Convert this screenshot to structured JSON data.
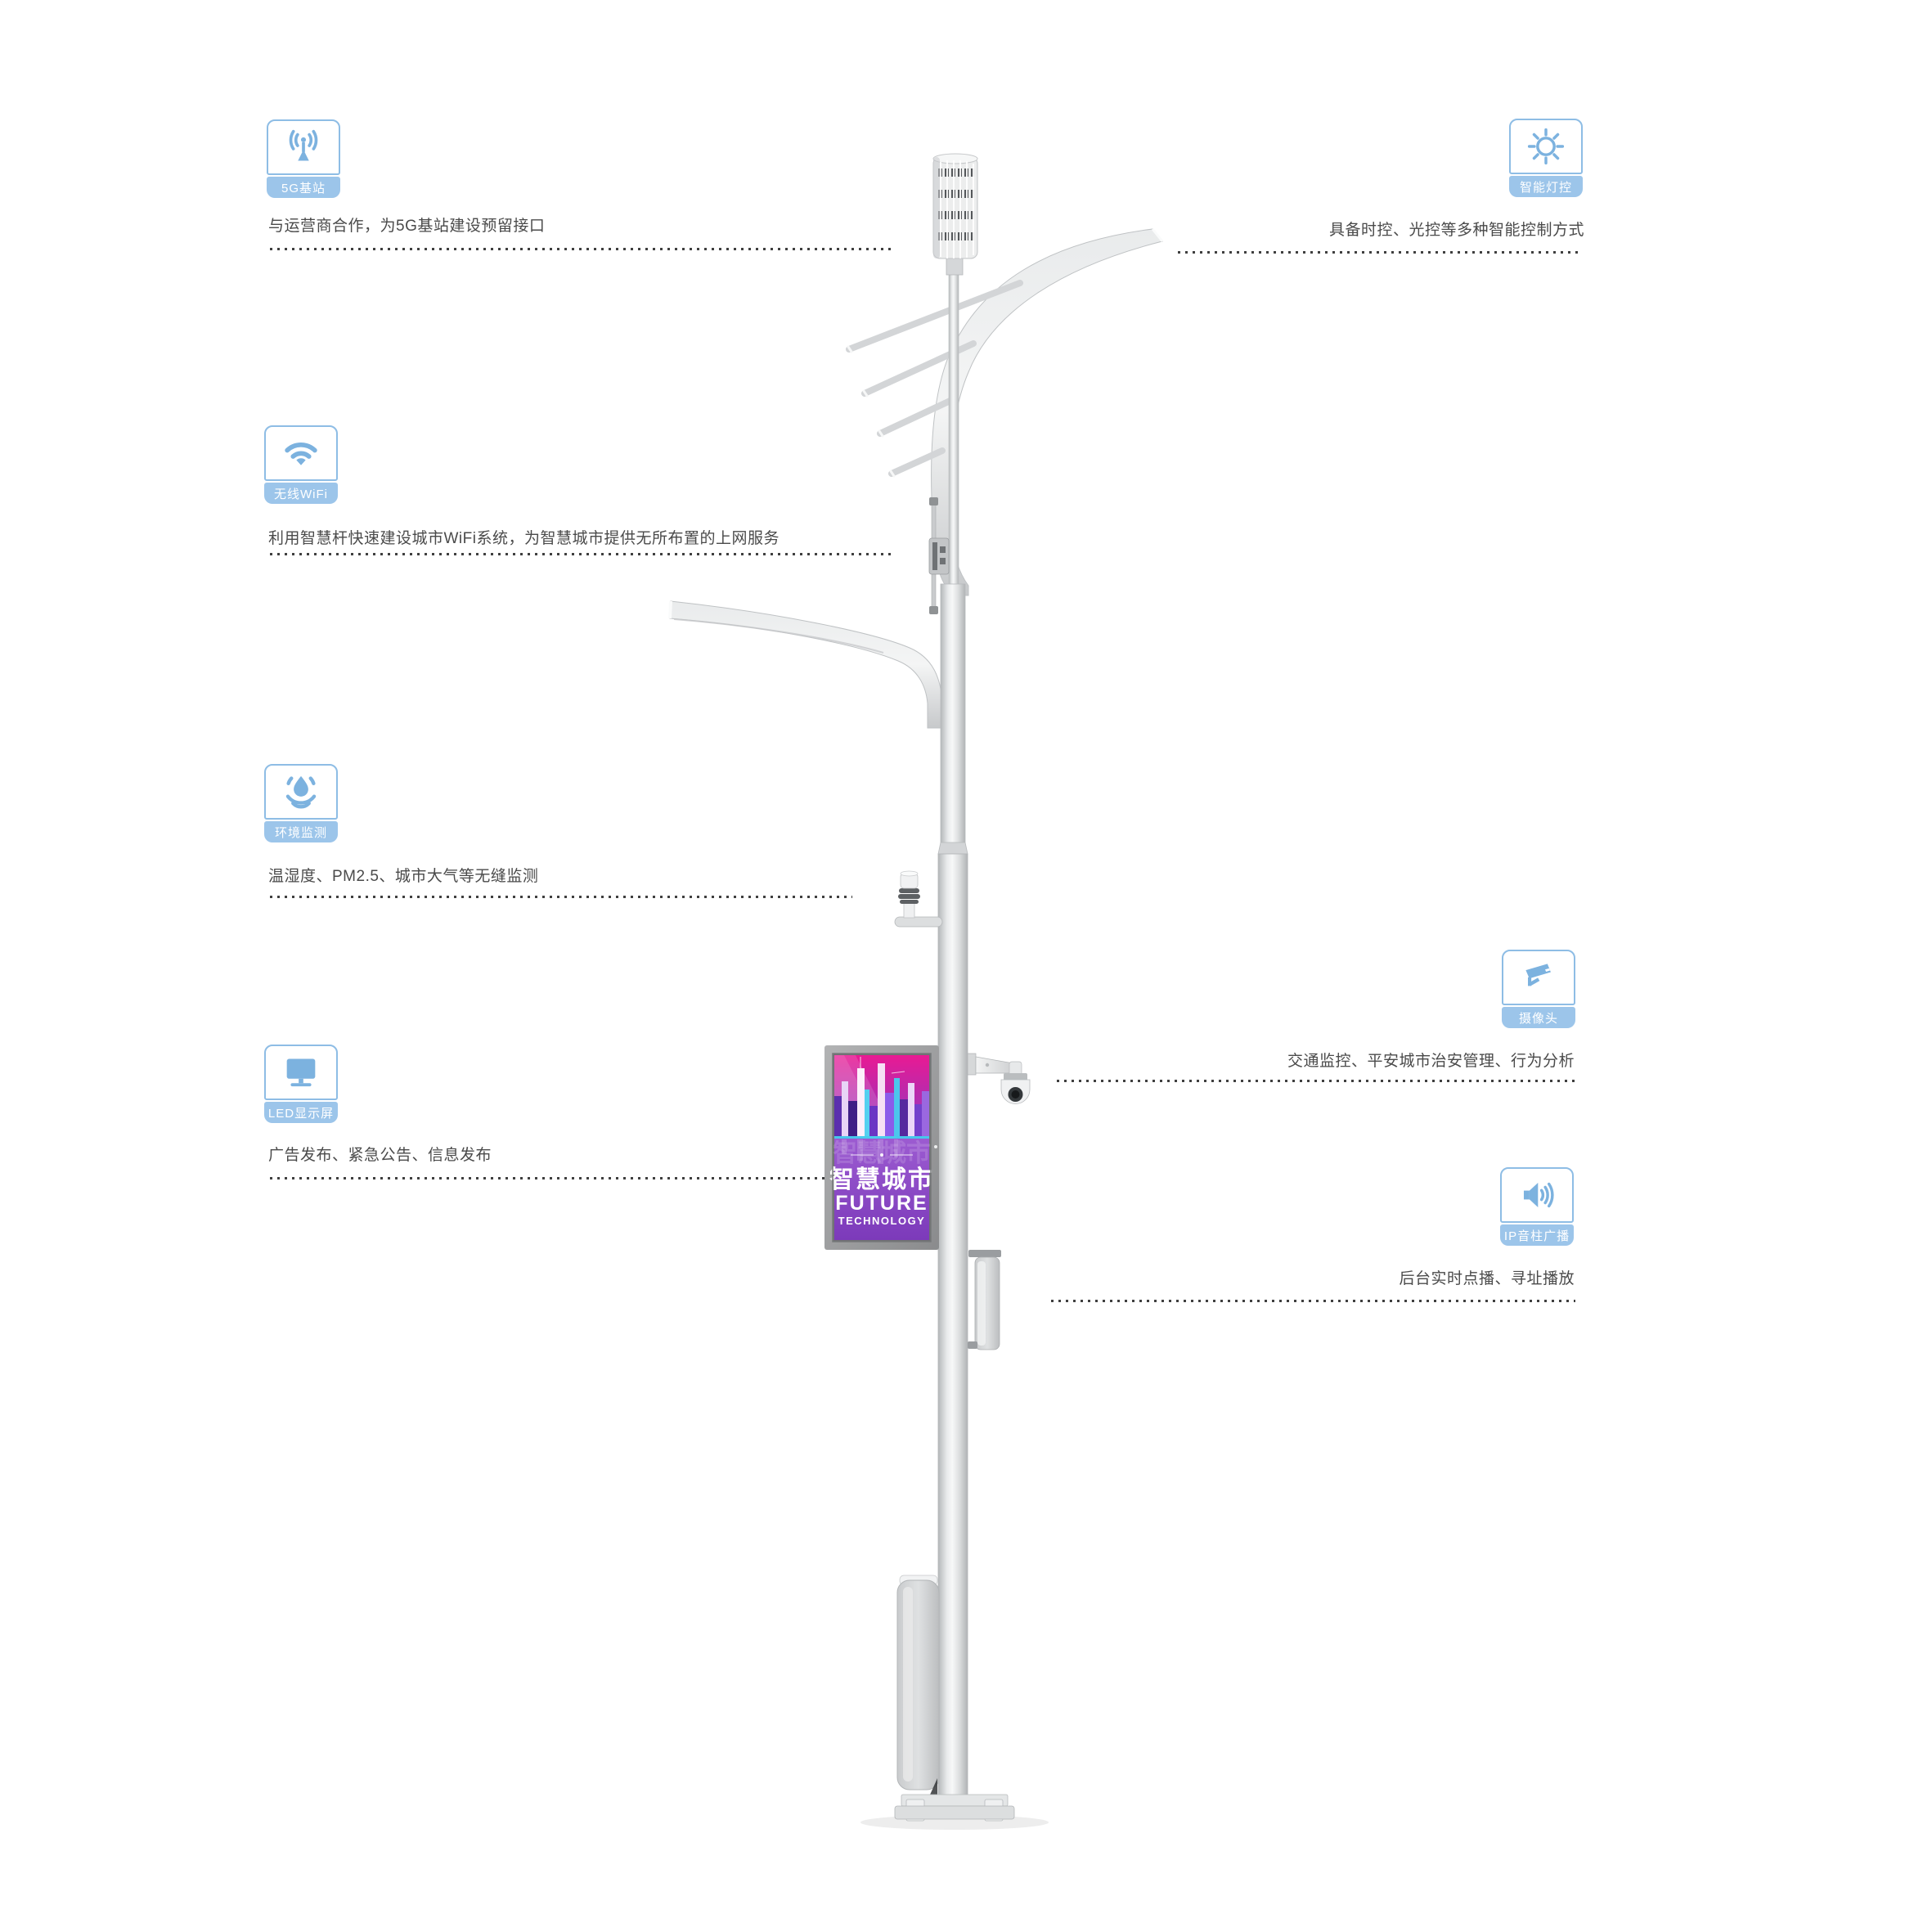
{
  "features_left": [
    {
      "label": "5G基站",
      "icon": "antenna-icon",
      "desc": "与运营商合作，为5G基站建设预留接口"
    },
    {
      "label": "无线WiFi",
      "icon": "wifi-icon",
      "desc": "利用智慧杆快速建设城市WiFi系统，为智慧城市提供无所布置的上网服务"
    },
    {
      "label": "环境监测",
      "icon": "water-drop-icon",
      "desc": "温湿度、PM2.5、城市大气等无缝监测"
    },
    {
      "label": "LED显示屏",
      "icon": "monitor-icon",
      "desc": "广告发布、紧急公告、信息发布"
    }
  ],
  "features_right": [
    {
      "label": "智能灯控",
      "icon": "sun-icon",
      "desc": "具备时控、光控等多种智能控制方式"
    },
    {
      "label": "摄像头",
      "icon": "cctv-camera-icon",
      "desc": "交通监控、平安城市治安管理、行为分析"
    },
    {
      "label": "IP音柱广播",
      "icon": "speaker-icon",
      "desc": "后台实时点播、寻址播放"
    }
  ],
  "screen": {
    "headline": "智慧城市",
    "line2": "FUTURE",
    "line3": "TECHNOLOGY"
  },
  "colors": {
    "icon_blue": "#7cb2df",
    "band_blue": "#9cc5ea",
    "text_gray": "#4a4a4a",
    "dot_gray": "#3f3f3f",
    "poster_top": "#e91a93",
    "poster_bottom": "#8747c9",
    "pole_gray": "#d9dbdc"
  }
}
